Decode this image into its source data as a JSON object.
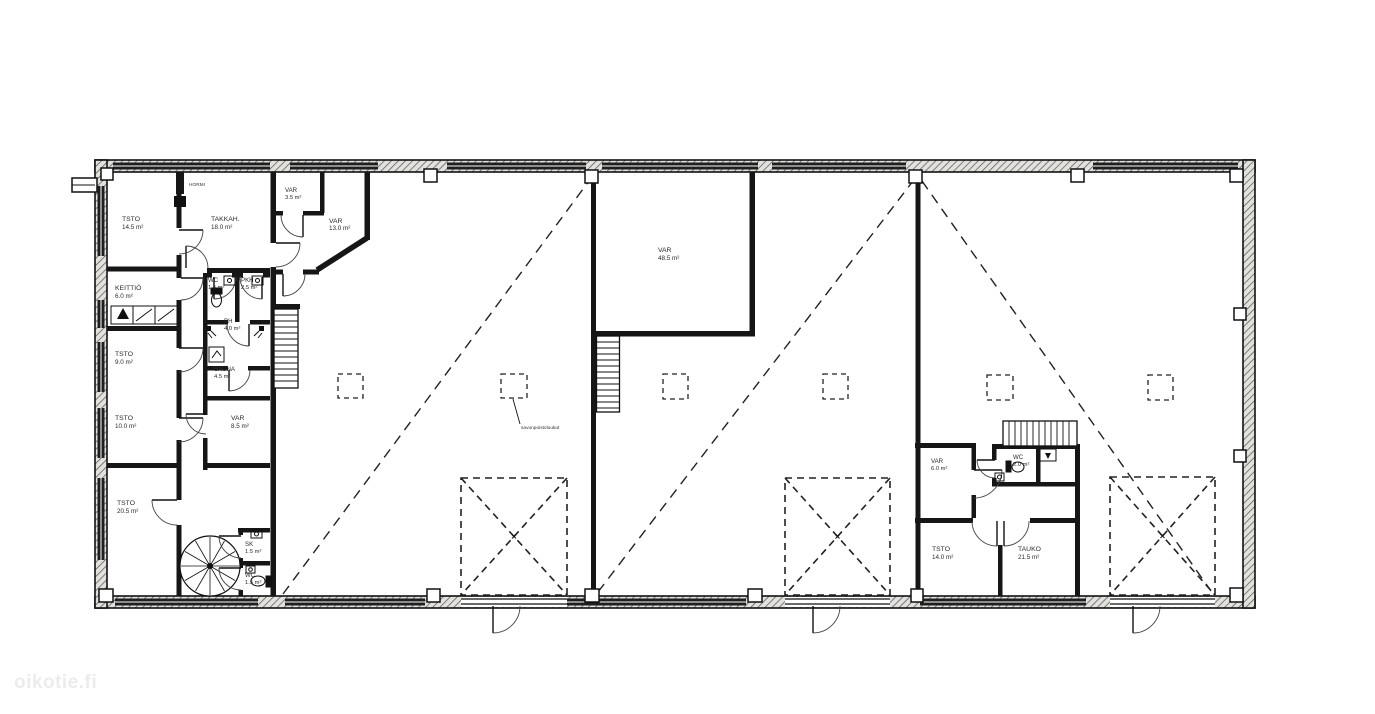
{
  "document": {
    "type": "architectural-floor-plan"
  },
  "watermark": {
    "text": "oikotie.fi",
    "color": "#ececec"
  },
  "annotations": {
    "chimney_label": "HORMI",
    "smoke_hatch_label": "savunpoistoluukut"
  },
  "palette": {
    "wall": "#161616",
    "line": "#222222",
    "label": "#2b2b2b"
  },
  "rooms": [
    {
      "name": "TSTO",
      "area": "14.5 m²"
    },
    {
      "name": "TAKKAH.",
      "area": "18.0 m²"
    },
    {
      "name": "VAR",
      "area": "3.5 m²"
    },
    {
      "name": "VAR",
      "area": "13.0 m²"
    },
    {
      "name": "KEITTIÖ",
      "area": "6.0 m²"
    },
    {
      "name": "WC",
      "area": "1.5 m²"
    },
    {
      "name": "PKH",
      "area": "2.5 m²"
    },
    {
      "name": "PH",
      "area": "4.0 m²"
    },
    {
      "name": "TSTO",
      "area": "9.0 m²"
    },
    {
      "name": "SAUNA",
      "area": "4.5 m²"
    },
    {
      "name": "TSTO",
      "area": "10.0 m²"
    },
    {
      "name": "VAR",
      "area": "8.5 m²"
    },
    {
      "name": "TSTO",
      "area": "20.5 m²"
    },
    {
      "name": "SK",
      "area": "1.5 m²"
    },
    {
      "name": "WC",
      "area": "1.5 m²"
    },
    {
      "name": "VAR",
      "area": "48.5 m²"
    },
    {
      "name": "VAR",
      "area": "6.0 m²"
    },
    {
      "name": "WC",
      "area": "2.0 m²"
    },
    {
      "name": "TSTO",
      "area": "14.0 m²"
    },
    {
      "name": "TAUKO",
      "area": "21.5 m²"
    }
  ]
}
